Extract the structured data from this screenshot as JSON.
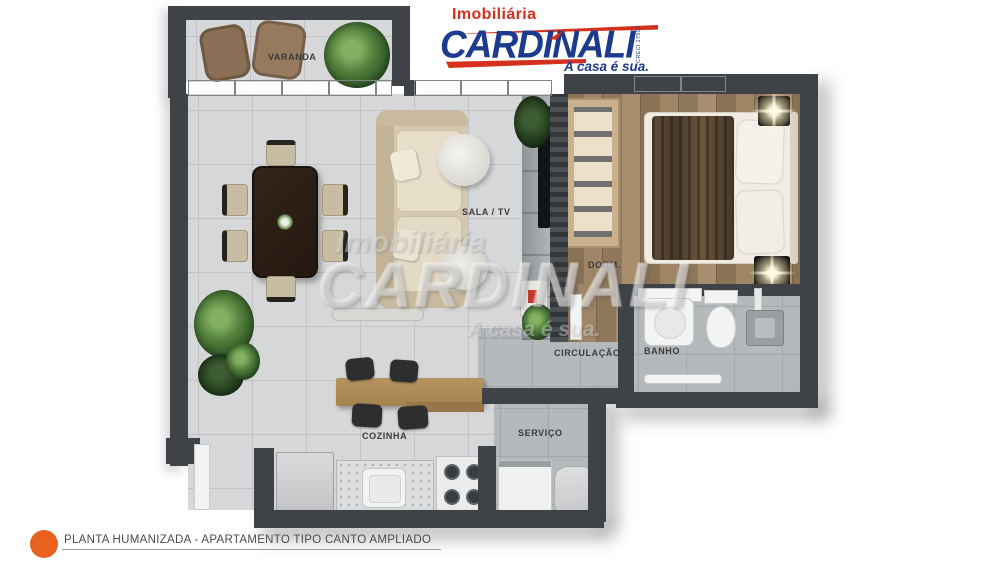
{
  "logo": {
    "imobiliaria": "Imobiliária",
    "name": "CARDINALI",
    "tagline": "A casa é sua.",
    "creci": "CRECI 1750J",
    "red": "#d5301c",
    "blue": "#1c3a8e"
  },
  "watermark": {
    "line1": "Imobiliária",
    "line2": "CARDINALI",
    "line3": "A casa é sua."
  },
  "rooms": {
    "varanda": {
      "label": "VARANDA"
    },
    "sala": {
      "label": "SALA / TV"
    },
    "dorm": {
      "label": "DORM."
    },
    "circulacao": {
      "label": "CIRCULAÇÃO"
    },
    "banho": {
      "label": "BANHO"
    },
    "cozinha": {
      "label": "COZINHA"
    },
    "servico": {
      "label": "SERVIÇO"
    }
  },
  "caption": {
    "text": "PLANTA HUMANIZADA - APARTAMENTO TIPO CANTO AMPLIADO",
    "bullet_color": "#e8611f"
  },
  "colors": {
    "wall": "#3f4246",
    "floor_light": "#d6d7d9",
    "floor_dark": "#b6b9bc",
    "wood_floor": "#97805f",
    "accent_orange": "#e8611f"
  }
}
